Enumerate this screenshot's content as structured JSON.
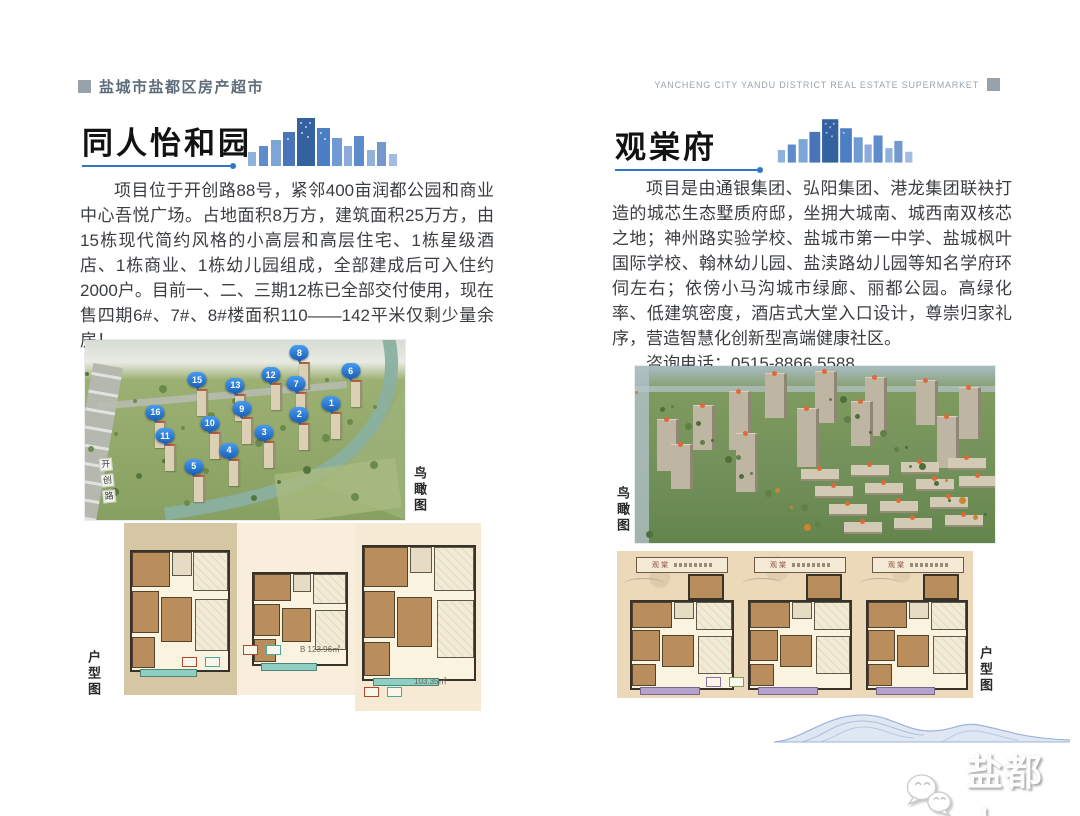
{
  "header": {
    "brand_zh": "盐城市盐都区房产超市",
    "brand_en": "YANCHENG CITY YANDU DISTRICT REAL ESTATE SUPERMARKET"
  },
  "listings": [
    {
      "title": "同人怡和园",
      "description": "项目位于开创路88号，紧邻400亩润都公园和商业中心吾悦广场。占地面积8万方，建筑面积25万方，由15栋现代简约风格的小高层和高层住宅、1栋星级酒店、1栋商业、1栋幼儿园组成，全部建成后可入住约2000户。目前一、二、三期12栋已全部交付使用，现在售四期6#、7#、8#楼面积110——142平米仅剩少量余房！",
      "phone_line": "咨询电话：0515-8189 7777",
      "aerial_label": "鸟瞰图",
      "floorplan_label": "户型图",
      "road_label": "开创路",
      "building_pins": [
        {
          "n": "8",
          "x": 67,
          "y": 3
        },
        {
          "n": "6",
          "x": 83,
          "y": 13
        },
        {
          "n": "12",
          "x": 58,
          "y": 15
        },
        {
          "n": "15",
          "x": 35,
          "y": 18
        },
        {
          "n": "13",
          "x": 47,
          "y": 21
        },
        {
          "n": "7",
          "x": 66,
          "y": 20
        },
        {
          "n": "1",
          "x": 77,
          "y": 31
        },
        {
          "n": "9",
          "x": 49,
          "y": 34
        },
        {
          "n": "2",
          "x": 67,
          "y": 37
        },
        {
          "n": "16",
          "x": 22,
          "y": 36
        },
        {
          "n": "10",
          "x": 39,
          "y": 42
        },
        {
          "n": "3",
          "x": 56,
          "y": 47
        },
        {
          "n": "11",
          "x": 25,
          "y": 49
        },
        {
          "n": "4",
          "x": 45,
          "y": 57
        },
        {
          "n": "5",
          "x": 34,
          "y": 66
        }
      ],
      "floorplan_notes": {
        "plan_b_area": "B 123.96㎡",
        "plan_c_area": "103.35㎡"
      }
    },
    {
      "title": "观棠府",
      "description": "项目是由通银集团、弘阳集团、港龙集团联袂打造的城芯生态墅质府邸，坐拥大城南、城西南双核芯之地；神州路实验学校、盐城市第一中学、盐城枫叶国际学校、翰林幼儿园、盐渎路幼儿园等知名学府环伺左右；依傍小马沟城市绿廊、丽都公园。高绿化率、低建筑密度，酒店式大堂入口设计，尊崇归家礼序，营造智慧化创新型高端健康社区。",
      "phone_line": "咨询电话：0515-8866 5588",
      "aerial_label": "鸟瞰图",
      "floorplan_label": "户型图",
      "plan_headers": [
        "观棠",
        "观棠",
        "观棠"
      ]
    }
  ],
  "footer": {
    "watermark_name": "盐都人"
  },
  "icons": {
    "skyline": "city-skyline-icon",
    "watermark": "wechat-chat-bubbles-icon",
    "pin": "numbered-location-pin"
  },
  "colors": {
    "accent_blue": "#2e77c5",
    "pin_blue": "#1c62ba",
    "brand_gray": "#99a1a9",
    "panel_tan": "#d5c6a4",
    "panel_cream": "#f9eedb",
    "strip_beige": "#ebd9ba"
  }
}
